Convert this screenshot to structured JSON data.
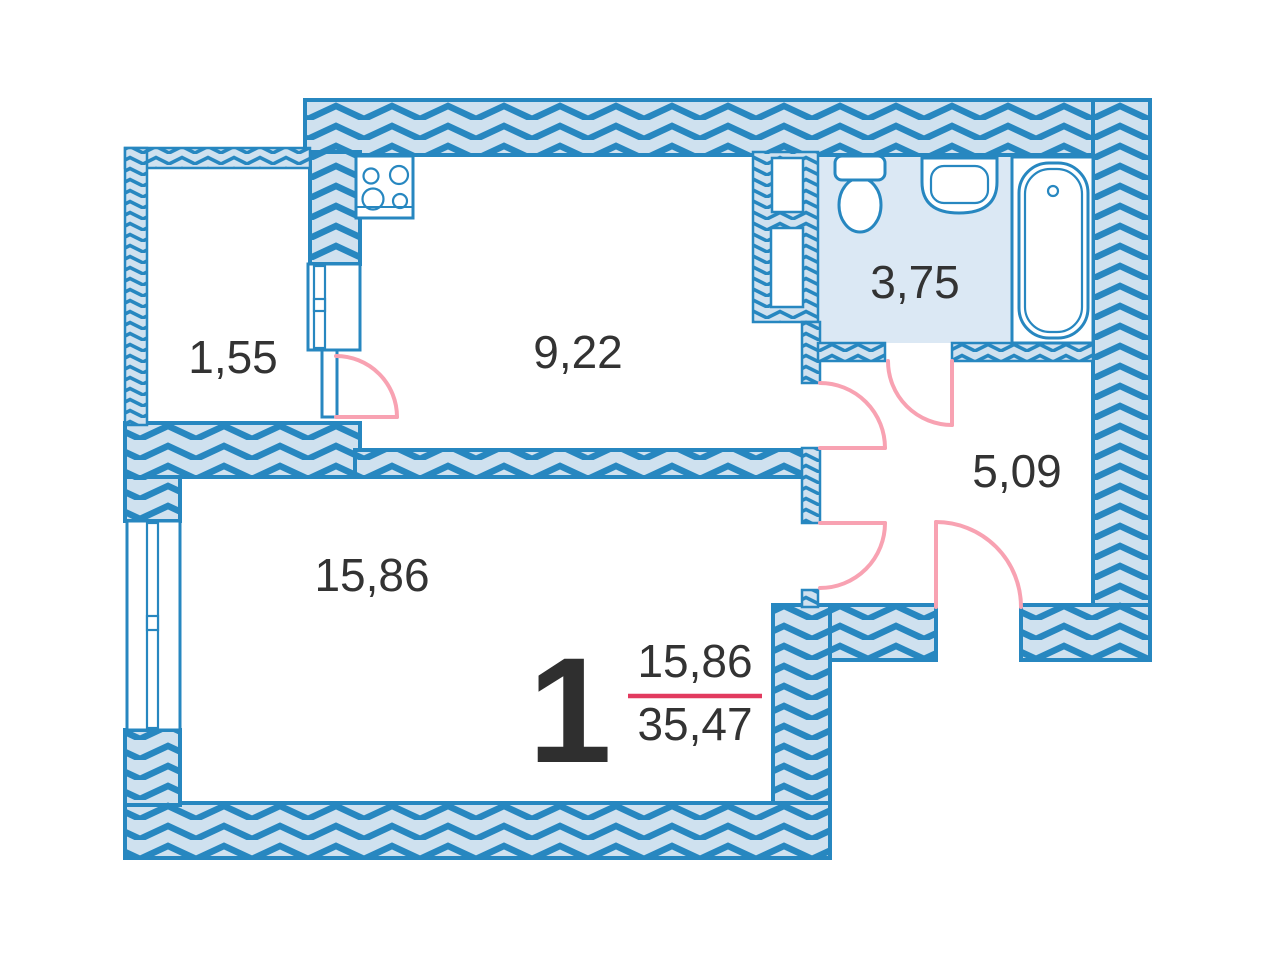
{
  "plan": {
    "type": "apartment-floor-plan",
    "apartment_number": "1",
    "living_area": "15,86",
    "total_area": "35,47"
  },
  "rooms": [
    {
      "id": "balcony",
      "area_label": "1,55"
    },
    {
      "id": "kitchen",
      "area_label": "9,22"
    },
    {
      "id": "bathroom",
      "area_label": "3,75"
    },
    {
      "id": "hallway",
      "area_label": "5,09"
    },
    {
      "id": "living-room",
      "area_label": "15,86"
    }
  ],
  "fixtures": [
    {
      "name": "stove",
      "room": "kitchen"
    },
    {
      "name": "toilet",
      "room": "bathroom"
    },
    {
      "name": "sink",
      "room": "bathroom"
    },
    {
      "name": "bathtub",
      "room": "bathroom"
    }
  ],
  "doors": [
    {
      "name": "balcony-door",
      "swing": "into-kitchen"
    },
    {
      "name": "kitchen-door",
      "swing": "into-hallway"
    },
    {
      "name": "bathroom-door",
      "swing": "into-hallway"
    },
    {
      "name": "living-door",
      "swing": "into-hallway"
    },
    {
      "name": "entrance-door",
      "swing": "into-hallway"
    }
  ],
  "windows": [
    {
      "name": "living-room-window",
      "wall": "west"
    },
    {
      "name": "balcony-block-window",
      "wall": "balcony-kitchen"
    }
  ],
  "colors": {
    "wall_fill": "#cfe1ef",
    "wall_stroke": "#2787c0",
    "bathroom_floor": "#dbe8f4",
    "door_swing": "#f8a2b2",
    "fraction_line": "#e23a5f",
    "label_text": "#333333"
  }
}
